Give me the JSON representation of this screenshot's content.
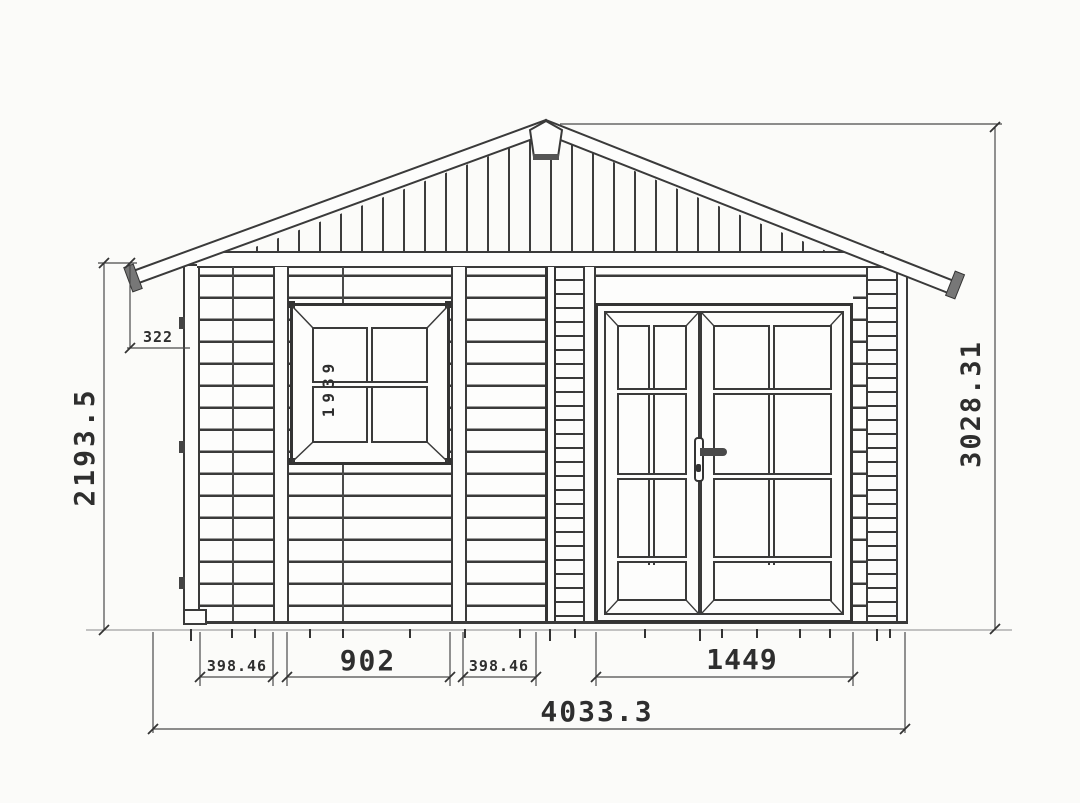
{
  "drawing": {
    "type": "garden-shed-front-elevation",
    "units": "mm",
    "labels": {
      "wall_height": "2193.5",
      "eave_drop": "322",
      "window_mark": "1939",
      "total_height": "3028.31",
      "left_bay": "398.46",
      "window_bay": "902",
      "mid_bay": "398.46",
      "door_bay": "1449",
      "total_width": "4033.3"
    },
    "colors": {
      "line": "#3a3a3a",
      "text": "#2e2e2e",
      "background": "#fbfbf9"
    }
  }
}
